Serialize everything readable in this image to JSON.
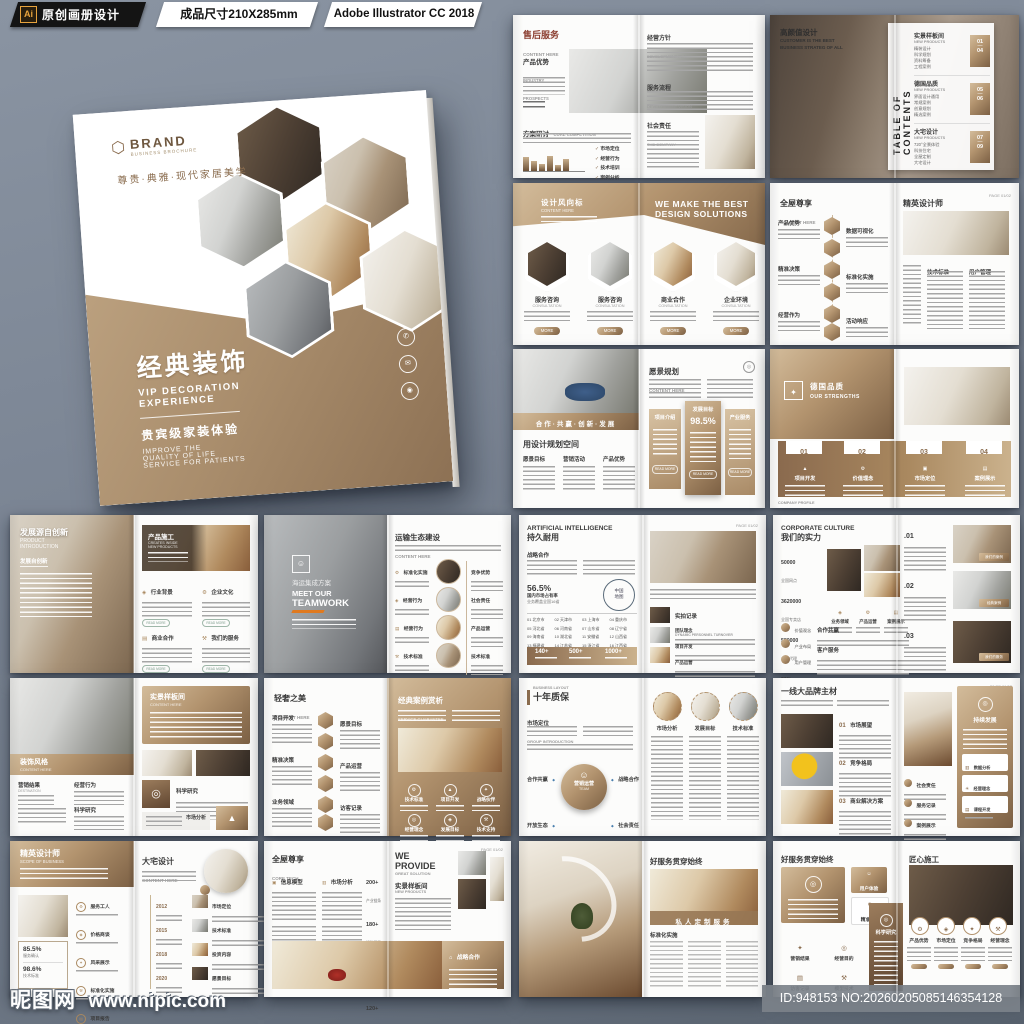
{
  "header": {
    "ai_logo": "Ai",
    "badge1": "原创画册设计",
    "badge2": "成品尺寸210X285mm",
    "badge3": "Adobe Illustrator CC 2018"
  },
  "footer": {
    "site_name": "昵图网",
    "site_url": "www.nipic.com",
    "image_id": "ID:948153 NO:20260205085146354128"
  },
  "colors": {
    "background": "#7b8594",
    "brown_light": "#d3bc9b",
    "brown_dark": "#7c6044",
    "accent_orange": "#e07a1f",
    "ai_yellow": "#f2a33c"
  },
  "icons": {
    "check": "✓",
    "cloud": "☁",
    "target": "◎",
    "triangle": "▲",
    "hexagon": "⬡",
    "phone": "✆",
    "mail": "✉",
    "globe": "◉",
    "home": "⌂",
    "gear": "⚙",
    "chart": "▥",
    "diamond": "◆",
    "star": "✦",
    "user": "☺",
    "box": "▣",
    "pin": "◈",
    "tools": "⚒",
    "doc": "▤",
    "dot": "●",
    "bulb": "☀"
  },
  "cover": {
    "brand": "BRAND",
    "brand_sub": "BUSINESS BROCHURE",
    "tagline": "尊贵·典雅·现代家居美学",
    "title_cn": "经典装饰",
    "title_en_1": "VIP DECORATION",
    "title_en_2": "EXPERIENCE",
    "sub_cn": "贵宾级家装体验",
    "sub_en_1": "IMPROVE THE",
    "sub_en_2": "QUALITY OF LIFE",
    "sub_en_3": "SERVICE FOR PATIENTS"
  },
  "spreads": [
    {
      "title_cn": "售后服务",
      "title_en": "CONTENT HERE",
      "sec1_cn": "产品优势",
      "sec1_en1": "INDUSTRY",
      "sec1_en2": "PROSPECTS",
      "sec2_cn": "方案研讨",
      "sec2_en": "CORE COMPETITION",
      "checks": [
        "市场定位",
        "经营行为",
        "技术培训",
        "案例分析"
      ],
      "bars": [
        58,
        40,
        30,
        62,
        24,
        48
      ],
      "r1_cn": "经营方针",
      "r1_en": "DEVELOPMENT PLAY",
      "r2_cn": "服务流程",
      "r2_en": "DEVELOPMENT VISION",
      "r3_cn": "社会责任",
      "r3_en": "THE COMPANY"
    },
    {
      "overlay_cn": "高颜值设计",
      "overlay_en": "CUSTOMER IS THE BEST BUSINESS STRATEG OF ALL",
      "toc": "TABLE OF CONTENTS",
      "sections": [
        {
          "cn": "实景样板间",
          "en": "NEW PRODUCTS",
          "n1": "01",
          "n2": "04",
          "items": [
            "精装设计",
            "科学规划",
            "资料筹备",
            "工程案例"
          ]
        },
        {
          "cn": "德国品质",
          "en": "NEW PRODUCTS",
          "n1": "05",
          "n2": "06",
          "items": [
            "界面设计通用",
            "常规案例",
            "创意规划",
            "精选案例"
          ]
        },
        {
          "cn": "大宅设计",
          "en": "NEW PRODUCTS",
          "n1": "07",
          "n2": "09",
          "items": [
            "720°全景体验",
            "科技住宅",
            "全屋定制",
            "大宅设计"
          ]
        }
      ]
    },
    {
      "left_cn": "设计风向标",
      "left_en": "CONTENT HERE",
      "heading1": "WE MAKE THE BEST",
      "heading2": "DESIGN SOLUTIONS",
      "cards": [
        {
          "cn": "服务咨询",
          "en": "CONSULTATION"
        },
        {
          "cn": "服务咨询",
          "en": "CONSULTATION"
        },
        {
          "cn": "商业合作",
          "en": "CONSULTATION"
        },
        {
          "cn": "企业环境",
          "en": "CONSULTATION"
        }
      ],
      "more": "MORE"
    },
    {
      "left_cn": "全屋尊享",
      "left_en": "CONTENT HERE",
      "hex_left": [
        "产品优势",
        "精准决策",
        "经营作为"
      ],
      "hex_right": [
        "数据可视化",
        "标准化实施",
        "活动响应"
      ],
      "right_cn": "精英设计师",
      "right_en": "CONTENT HERE",
      "page_no": "PAGE 01/02",
      "col1": "技术标准",
      "col2": "用户管理"
    },
    {
      "banner": "合作·共赢·创新·发展",
      "left_title": "用设计规划空间",
      "cols": [
        "愿景目标",
        "营销活动",
        "产品优势"
      ],
      "right_cn": "愿景规划",
      "right_en": "CONTENT HERE",
      "cards": [
        {
          "label": "项目介绍"
        },
        {
          "label": "发展目标",
          "stat": "98.5%"
        },
        {
          "label": "产业服务"
        }
      ],
      "read_more": "READ MORE"
    },
    {
      "block_cn": "德国品质",
      "block_en": "OUR STRENGTHS",
      "cloud_note": "ALL DATA IS PERFECTLY SAVE ON OUR CLOUD",
      "steps": [
        {
          "num": "01",
          "label": "项目开发"
        },
        {
          "num": "02",
          "label": "价值理念"
        },
        {
          "num": "03",
          "label": "市场定位"
        },
        {
          "num": "04",
          "label": "案例展示"
        }
      ],
      "footnote": "COMPANY PROFILE"
    },
    {
      "left_cn": "发展源自创新",
      "left_en1": "PRODUCT",
      "left_en2": "INTRODUCTION",
      "left_sub": "发展自创新",
      "card_cn": "产品施工",
      "card_en1": "CREATES INSIDE",
      "card_en2": "NEW PRODUCTS",
      "items": [
        "行业背景",
        "企业文化",
        "商业合作",
        "我们的服务"
      ],
      "read_more": "READ MORE"
    },
    {
      "overlay_cn": "海运集成方案",
      "overlay_en1": "MEET OUR",
      "overlay_en2": "TEAMWORK",
      "right_cn": "运输生态建设",
      "right_en": "CONTENT HERE",
      "left_items": [
        "标准化实施",
        "经营行为",
        "经营行为",
        "技术标准"
      ],
      "right_items": [
        "竞争优势",
        "社会责任",
        "产品运营",
        "技术标准"
      ]
    },
    {
      "title_en": "ARTIFICIAL INTELLIGENCE",
      "title_cn": "持久耐用",
      "sub": "战略合作",
      "stat": "56.5%",
      "stat_l1": "国内市场占有率",
      "stat_l2": "业务覆盖全国16省",
      "map_l1": "中国",
      "map_l2": "地图",
      "provinces": [
        "01 北京市",
        "02 天津市",
        "03 上海市",
        "04 重庆市",
        "05 河北省",
        "06 河南省",
        "07 山东省",
        "08 辽宁省",
        "09 海南省",
        "10 湖北省",
        "11 安徽省",
        "12 山西省",
        "13 福建省",
        "14 江苏省",
        "15 浙江省",
        "16 江西省"
      ],
      "counters": [
        "140+",
        "500+",
        "1000+"
      ],
      "page_no": "PAGE 01/02",
      "sec_cn": "实拍记录",
      "sec_en": "DYNAMIC PERSONNEL TURNOVER",
      "rows": [
        "团队理念",
        "项目开发",
        "产品运营"
      ]
    },
    {
      "title_en": "CORPORATE CULTURE",
      "title_cn": "我们的实力",
      "stats": [
        {
          "v": "50000",
          "l": "全国网点"
        },
        {
          "v": "3620000",
          "l": "全国专卖店"
        },
        {
          "v": "580000",
          "l": "电商代理"
        },
        {
          "v": "30%",
          "l": "市场份额"
        }
      ],
      "icon_cols": [
        "业务领域",
        "产品运营",
        "案例展示"
      ],
      "circles": [
        "价值观念",
        "产业布局",
        "用户管理"
      ],
      "sec1": "合作共赢",
      "sec2": "客户服务",
      "items": [
        {
          "num": ".01",
          "cap": "我们的案例"
        },
        {
          "num": ".02",
          "cap": "经典案例"
        },
        {
          "num": ".03",
          "cap": "我们的服务"
        }
      ]
    },
    {
      "band_cn": "装饰风格",
      "band_en": "CONTENT HERE",
      "col1_cn": "营销结果",
      "col1_en": "DESTINATION",
      "col2": "经营行为",
      "col3": "科学研究",
      "card_cn": "实景样板间",
      "card_en": "CONTENT HERE",
      "sec1": "科学研究",
      "sec2": "市场分析"
    },
    {
      "left_cn": "轻奢之美",
      "left_en": "CONTENT HERE",
      "hex_left": [
        "项目开发",
        "精准决策",
        "业务领域"
      ],
      "hex_right": [
        "愿景目标",
        "产品运营",
        "访客记录"
      ],
      "right_cn": "经典案例赏析",
      "right_en": "SERVICE GUARANTEE",
      "grid": [
        "技术标准",
        "项目开发",
        "战略伙伴",
        "经营理念",
        "发展目标",
        "技术支持"
      ]
    },
    {
      "small": "BUSINESS LAYOUT",
      "title": "十年质保",
      "sec_cn": "市场定位",
      "sec_en": "GROUP INTRODUCTION",
      "bubble_cn": "营销运营",
      "bubble_en": "TEAM",
      "corners": [
        "合作共赢",
        "战略合作",
        "开放生态",
        "社会责任"
      ],
      "right_circles": [
        "市场分析",
        "发展目标",
        "技术标准"
      ]
    },
    {
      "title": "一线大品牌主材",
      "page_no": "PAGE 01/02",
      "sections": [
        {
          "num": "01",
          "label": "市场展望"
        },
        {
          "num": "02",
          "label": "竞争格局"
        },
        {
          "num": "03",
          "label": "商业解决方案"
        }
      ],
      "bullets": [
        "社会责任",
        "服务记录",
        "案例展示"
      ],
      "side_cn": "持续发展",
      "side_cards": [
        "数据分析",
        "经营理念",
        "课程开发"
      ]
    },
    {
      "header_cn": "精英设计师",
      "header_en": "SCOPE OF BUSINESS",
      "stat1_v": "85.5%",
      "stat1_l": "服务确认",
      "stat2_v": "98.6%",
      "stat2_l": "技术标准",
      "bullets": [
        "服务工人",
        "价格商谈",
        "风采展示",
        "标准化实施",
        "项目报告",
        "精英团队"
      ],
      "right_cn": "大宅设计",
      "right_en": "CONTENT HERE",
      "timeline": [
        {
          "y": "2012",
          "l": "产业链端"
        },
        {
          "y": "2015",
          "l": "覆盖延伸"
        },
        {
          "y": "2018",
          "l": "文化教育"
        },
        {
          "y": "2020",
          "l": "企业愿景"
        }
      ],
      "right_items": [
        "市场定位",
        "技术标准",
        "投资内容",
        "愿景目标"
      ]
    },
    {
      "left_cn": "全屋尊享",
      "left_en": "CORE TECH",
      "col1": "信息模型",
      "col2": "市场分析",
      "stats": [
        {
          "v": "200+",
          "l": "产业链条"
        },
        {
          "v": "180+",
          "l": "活动项目"
        },
        {
          "v": "600+",
          "l": "项目报告"
        },
        {
          "v": "120+",
          "l": "案例展示"
        }
      ],
      "we": "WE",
      "provide": "PROVIDE",
      "great": "GREAT SOLUTION",
      "right_cn": "实景样板间",
      "right_sub": "NEW PRODUCTS",
      "panel_cn": "战略合作",
      "page_no": "PAGE 01/02"
    },
    {
      "right_cn": "好服务贯穿始终",
      "right_en": "CONTENT HERE",
      "overlay": "私人定制服务",
      "sec": "标准化实施"
    },
    {
      "left_cn": "好服务贯穿始终",
      "left_en": "OUR MESSAGE THE COMPANY",
      "chip1": "用户体验",
      "chip2": "精准决策",
      "icons": [
        "营销结果",
        "经营目的",
        "访客记录",
        "模型技术"
      ],
      "panel": "科学研究",
      "right_cn": "匠心施工",
      "right_en": "OUR MESSAGE THE COMPANY",
      "circle_items": [
        "产品优势",
        "市场定位",
        "竞争格局",
        "经营理念"
      ]
    }
  ]
}
